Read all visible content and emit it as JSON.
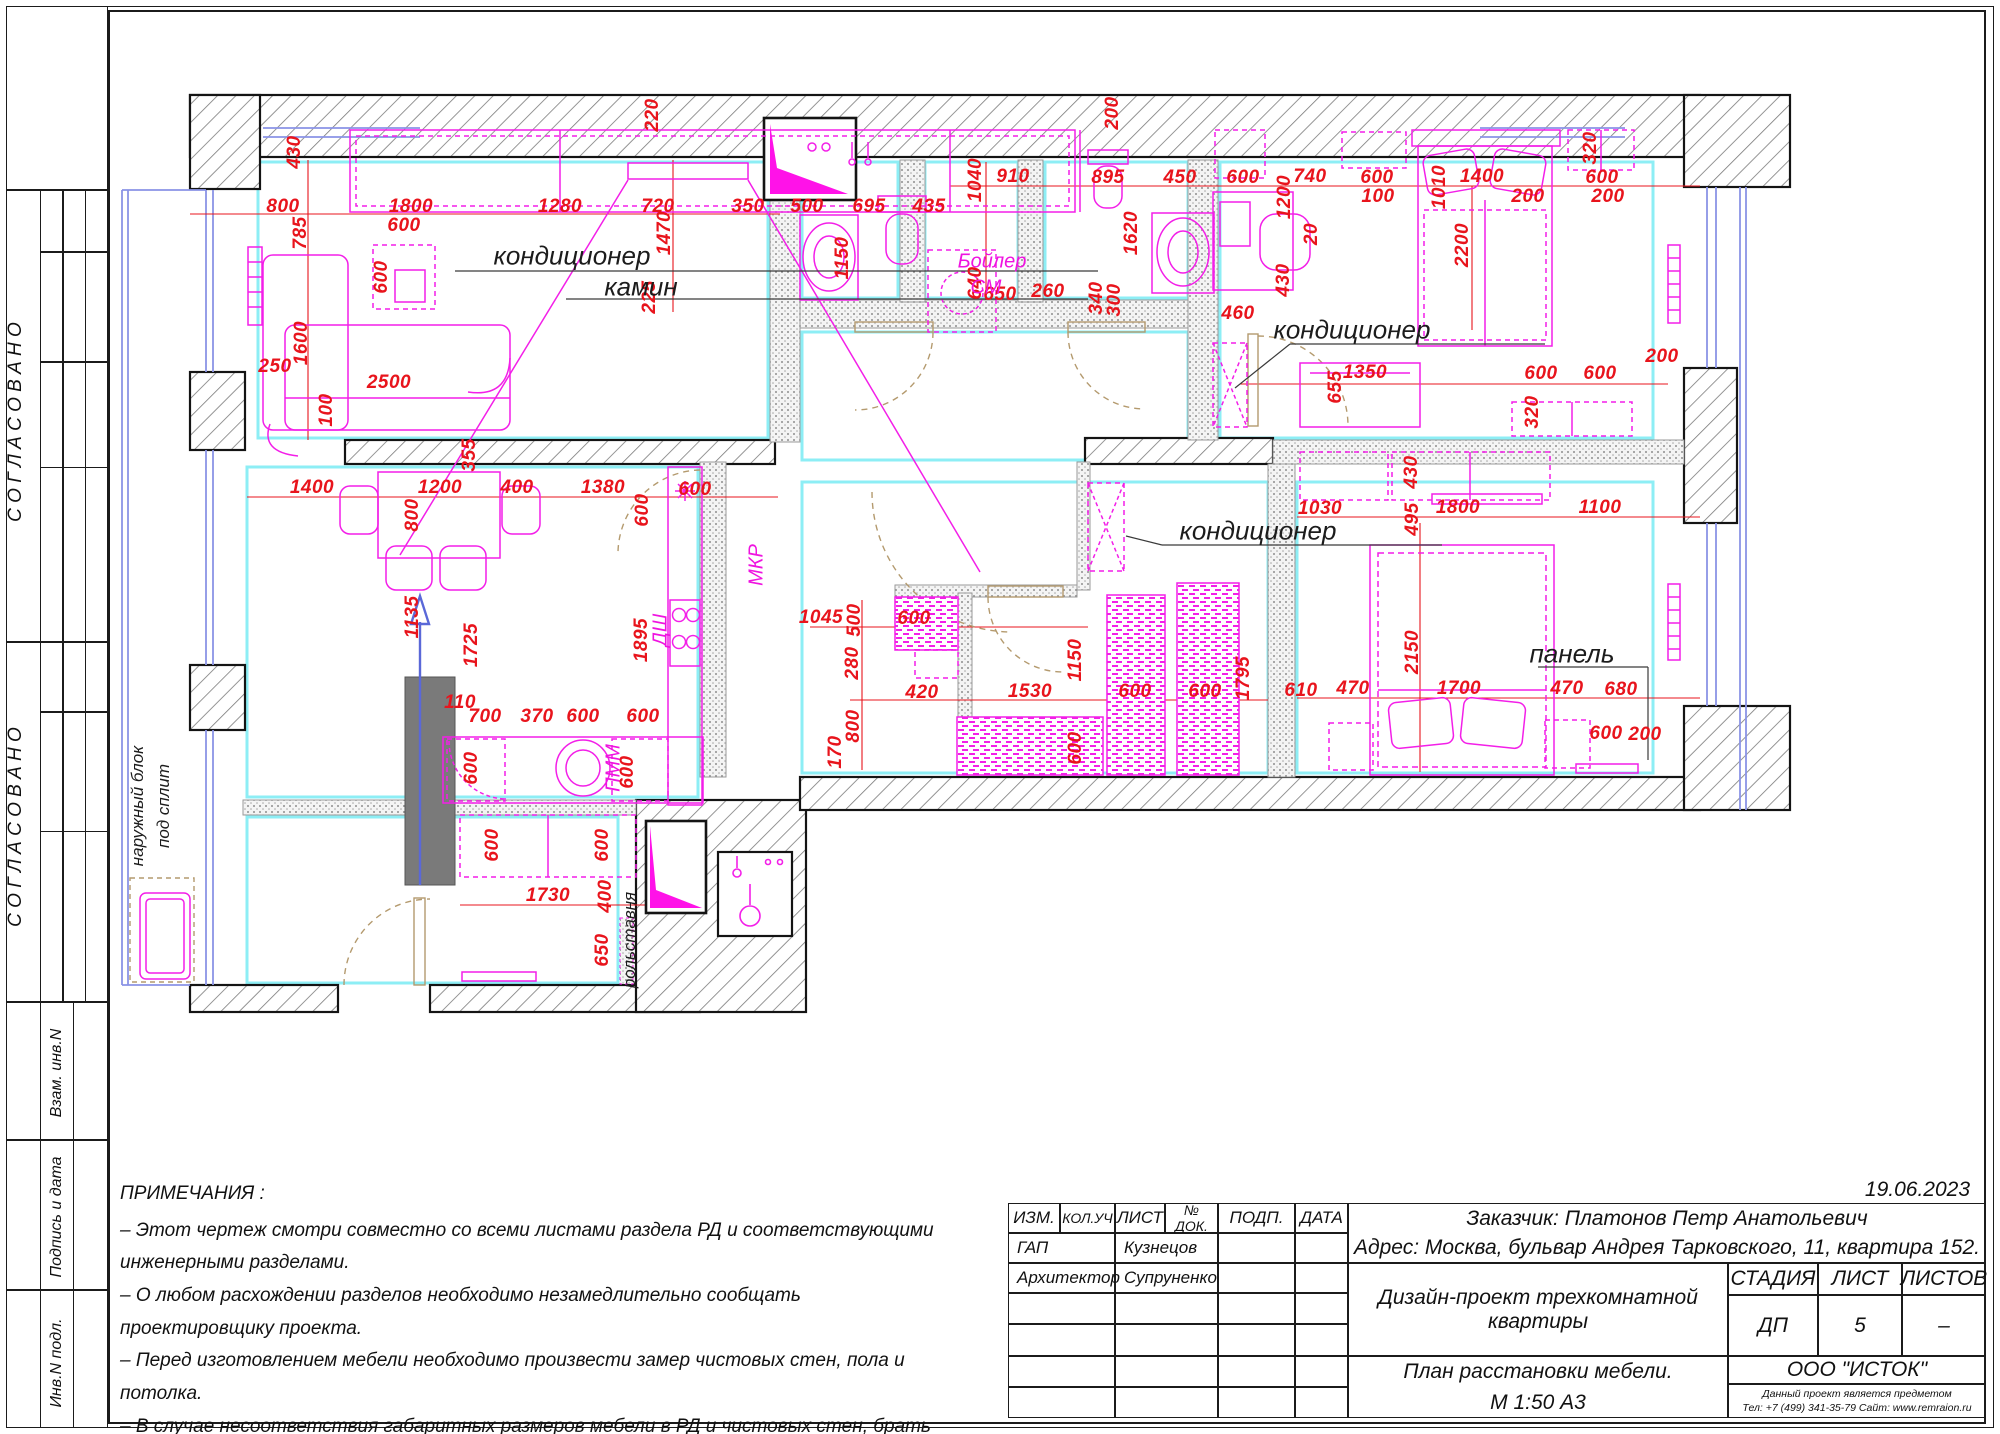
{
  "side_strip": {
    "labels": [
      "С О Г Л А С О В А Н О",
      "С О Г Л А С О В А Н О",
      "Взам. инв.N",
      "Подпись и дата",
      "Инв.N подл."
    ]
  },
  "notes": {
    "title": "ПРИМЕЧАНИЯ :",
    "items": [
      "–  Этот чертеж смотри совместно со всеми листами раздела РД и соответствующими инженерными разделами.",
      "–  О любом расхождении разделов необходимо незамедлительно сообщать проектировщику проекта.",
      "–  Перед изготовлением мебели необходимо произвести замер чистовых стен, пола и потолка.",
      "–  В случае несоответствия габаритных размеров мебели в РД и чистовых стен, брать за основу размеры чистовых стен."
    ]
  },
  "title_block": {
    "date": "19.06.2023",
    "columns": [
      "ИЗМ.",
      "КОЛ.УЧ",
      "ЛИСТ",
      "№ ДОК.",
      "ПОДП.",
      "ДАТА"
    ],
    "rows": [
      {
        "role": "ГАП",
        "name": "Кузнецов"
      },
      {
        "role": "Архитектор",
        "name": "Супруненко"
      }
    ],
    "client": "Заказчик: Платонов Петр Анатольевич",
    "address": "Адрес: Москва, бульвар Андрея Тарковского, 11, квартира 152.",
    "project": "Дизайн-проект трехкомнатной квартиры",
    "stage_label": "СТАДИЯ",
    "sheet_label": "ЛИСТ",
    "sheets_label": "ЛИСТОВ",
    "stage": "ДП",
    "sheet_no": "5",
    "sheets_total": "–",
    "drawing_title": "План расстановки мебели.",
    "drawing_scale": "М 1:50  А3",
    "company": "ООО \"ИСТОК\"",
    "copyright": "Данный проект является предметом авторского права. Тиражирование, публикация, использование в строительстве, прочее коммерческое использование возможно только с согласованием ООО \"ИСТОК\". Защищено законом РФ об авторском праве.",
    "phone": "Тел: +7 (499) 341-35-79  Сайт: www.remraion.ru"
  },
  "plan": {
    "colors": {
      "dim_red": "#e8141c",
      "furniture_magenta": "#f31fe8",
      "wall_black": "#141414",
      "lining_cyan": "#8deef5",
      "door_tan": "#b49a6e",
      "window_blue": "#8a93e6"
    },
    "callouts": [
      {
        "t": "кондиционер",
        "x": 572,
        "y": 256
      },
      {
        "t": "камин",
        "x": 641,
        "y": 287
      },
      {
        "t": "кондиционер",
        "x": 1352,
        "y": 330
      },
      {
        "t": "кондиционер",
        "x": 1258,
        "y": 531
      },
      {
        "t": "панель",
        "x": 1572,
        "y": 654
      },
      {
        "t": "Бойлер",
        "x": 992,
        "y": 262,
        "m": 1
      },
      {
        "t": "СМ",
        "x": 986,
        "y": 288,
        "m": 1
      },
      {
        "t": "МКР",
        "x": 757,
        "y": 565,
        "m": 1,
        "v": 1
      },
      {
        "t": "ДШ",
        "x": 661,
        "y": 630,
        "m": 1,
        "v": 1
      },
      {
        "t": "ПММ",
        "x": 614,
        "y": 768,
        "m": 1,
        "v": 1
      },
      {
        "t": "рольставня",
        "x": 630,
        "y": 940,
        "v": 1,
        "s": 1
      },
      {
        "t": "наружный блок",
        "x": 138,
        "y": 806,
        "v": 1,
        "s": 1
      },
      {
        "t": "под сплит",
        "x": 164,
        "y": 806,
        "v": 1,
        "s": 1
      }
    ],
    "dims": [
      {
        "t": "800",
        "x": 283,
        "y": 207
      },
      {
        "t": "1800",
        "x": 411,
        "y": 207
      },
      {
        "t": "600",
        "x": 404,
        "y": 226
      },
      {
        "t": "1280",
        "x": 560,
        "y": 207
      },
      {
        "t": "720",
        "x": 658,
        "y": 207
      },
      {
        "t": "350",
        "x": 748,
        "y": 207
      },
      {
        "t": "500",
        "x": 807,
        "y": 207
      },
      {
        "t": "695",
        "x": 869,
        "y": 207
      },
      {
        "t": "435",
        "x": 929,
        "y": 207
      },
      {
        "t": "430",
        "x": 295,
        "y": 152,
        "v": 1
      },
      {
        "t": "785",
        "x": 301,
        "y": 233,
        "v": 1
      },
      {
        "t": "220",
        "x": 653,
        "y": 115,
        "v": 1
      },
      {
        "t": "1470",
        "x": 665,
        "y": 233,
        "v": 1
      },
      {
        "t": "225",
        "x": 650,
        "y": 297,
        "v": 1
      },
      {
        "t": "600",
        "x": 382,
        "y": 277,
        "v": 1
      },
      {
        "t": "1600",
        "x": 302,
        "y": 343,
        "v": 1
      },
      {
        "t": "100",
        "x": 327,
        "y": 410,
        "v": 1
      },
      {
        "t": "250",
        "x": 275,
        "y": 367
      },
      {
        "t": "2500",
        "x": 389,
        "y": 383
      },
      {
        "t": "1040",
        "x": 976,
        "y": 180,
        "v": 1
      },
      {
        "t": "910",
        "x": 1013,
        "y": 177
      },
      {
        "t": "1150",
        "x": 843,
        "y": 258,
        "v": 1
      },
      {
        "t": "640",
        "x": 976,
        "y": 283,
        "v": 1
      },
      {
        "t": "650",
        "x": 1000,
        "y": 295
      },
      {
        "t": "260",
        "x": 1048,
        "y": 292
      },
      {
        "t": "340",
        "x": 1097,
        "y": 298,
        "v": 1
      },
      {
        "t": "300",
        "x": 1115,
        "y": 300,
        "v": 1
      },
      {
        "t": "895",
        "x": 1108,
        "y": 178
      },
      {
        "t": "450",
        "x": 1180,
        "y": 178
      },
      {
        "t": "1620",
        "x": 1132,
        "y": 233,
        "v": 1
      },
      {
        "t": "200",
        "x": 1113,
        "y": 113,
        "v": 1
      },
      {
        "t": "600",
        "x": 1243,
        "y": 178
      },
      {
        "t": "740",
        "x": 1310,
        "y": 177
      },
      {
        "t": "1200",
        "x": 1285,
        "y": 197,
        "v": 1
      },
      {
        "t": "600",
        "x": 1377,
        "y": 178
      },
      {
        "t": "100",
        "x": 1378,
        "y": 197
      },
      {
        "t": "1010",
        "x": 1440,
        "y": 187,
        "v": 1
      },
      {
        "t": "1400",
        "x": 1482,
        "y": 177
      },
      {
        "t": "200",
        "x": 1528,
        "y": 197
      },
      {
        "t": "320",
        "x": 1591,
        "y": 148,
        "v": 1
      },
      {
        "t": "600",
        "x": 1602,
        "y": 178
      },
      {
        "t": "200",
        "x": 1608,
        "y": 197
      },
      {
        "t": "20",
        "x": 1312,
        "y": 234,
        "v": 1
      },
      {
        "t": "2200",
        "x": 1463,
        "y": 245,
        "v": 1
      },
      {
        "t": "430",
        "x": 1284,
        "y": 280,
        "v": 1
      },
      {
        "t": "460",
        "x": 1238,
        "y": 314
      },
      {
        "t": "1350",
        "x": 1365,
        "y": 373
      },
      {
        "t": "655",
        "x": 1336,
        "y": 387,
        "v": 1
      },
      {
        "t": "600",
        "x": 1541,
        "y": 374
      },
      {
        "t": "600",
        "x": 1600,
        "y": 374
      },
      {
        "t": "200",
        "x": 1662,
        "y": 357
      },
      {
        "t": "320",
        "x": 1533,
        "y": 412,
        "v": 1
      },
      {
        "t": "355",
        "x": 470,
        "y": 455,
        "v": 1
      },
      {
        "t": "1400",
        "x": 312,
        "y": 488
      },
      {
        "t": "1200",
        "x": 440,
        "y": 488
      },
      {
        "t": "400",
        "x": 517,
        "y": 488
      },
      {
        "t": "1380",
        "x": 603,
        "y": 488
      },
      {
        "t": "600",
        "x": 695,
        "y": 490
      },
      {
        "t": "800",
        "x": 413,
        "y": 515,
        "v": 1
      },
      {
        "t": "600",
        "x": 643,
        "y": 510,
        "v": 1
      },
      {
        "t": "1135",
        "x": 413,
        "y": 617,
        "v": 1
      },
      {
        "t": "1725",
        "x": 472,
        "y": 645,
        "v": 1
      },
      {
        "t": "1895",
        "x": 642,
        "y": 640,
        "v": 1
      },
      {
        "t": "110",
        "x": 460,
        "y": 703
      },
      {
        "t": "700",
        "x": 485,
        "y": 717
      },
      {
        "t": "370",
        "x": 537,
        "y": 717
      },
      {
        "t": "600",
        "x": 583,
        "y": 717
      },
      {
        "t": "600",
        "x": 643,
        "y": 717
      },
      {
        "t": "600",
        "x": 472,
        "y": 768,
        "v": 1
      },
      {
        "t": "600",
        "x": 628,
        "y": 772,
        "v": 1
      },
      {
        "t": "1045",
        "x": 821,
        "y": 618
      },
      {
        "t": "500",
        "x": 855,
        "y": 620,
        "v": 1
      },
      {
        "t": "600",
        "x": 914,
        "y": 619
      },
      {
        "t": "280",
        "x": 853,
        "y": 663,
        "v": 1
      },
      {
        "t": "420",
        "x": 922,
        "y": 693
      },
      {
        "t": "800",
        "x": 854,
        "y": 726,
        "v": 1
      },
      {
        "t": "170",
        "x": 836,
        "y": 752,
        "v": 1
      },
      {
        "t": "1530",
        "x": 1030,
        "y": 692
      },
      {
        "t": "1150",
        "x": 1076,
        "y": 660,
        "v": 1
      },
      {
        "t": "600",
        "x": 1076,
        "y": 748,
        "v": 1
      },
      {
        "t": "600",
        "x": 1135,
        "y": 692
      },
      {
        "t": "600",
        "x": 1205,
        "y": 692
      },
      {
        "t": "1795",
        "x": 1244,
        "y": 678,
        "v": 1
      },
      {
        "t": "1030",
        "x": 1320,
        "y": 509
      },
      {
        "t": "430",
        "x": 1412,
        "y": 472,
        "v": 1
      },
      {
        "t": "495",
        "x": 1413,
        "y": 519,
        "v": 1
      },
      {
        "t": "1800",
        "x": 1458,
        "y": 508
      },
      {
        "t": "1100",
        "x": 1600,
        "y": 508
      },
      {
        "t": "2150",
        "x": 1413,
        "y": 652,
        "v": 1
      },
      {
        "t": "610",
        "x": 1301,
        "y": 691
      },
      {
        "t": "470",
        "x": 1353,
        "y": 689
      },
      {
        "t": "1700",
        "x": 1459,
        "y": 689
      },
      {
        "t": "470",
        "x": 1567,
        "y": 689
      },
      {
        "t": "680",
        "x": 1621,
        "y": 690
      },
      {
        "t": "600",
        "x": 1606,
        "y": 734
      },
      {
        "t": "200",
        "x": 1645,
        "y": 735
      },
      {
        "t": "1730",
        "x": 548,
        "y": 896
      },
      {
        "t": "400",
        "x": 606,
        "y": 896,
        "v": 1
      },
      {
        "t": "650",
        "x": 603,
        "y": 950,
        "v": 1
      },
      {
        "t": "600",
        "x": 493,
        "y": 845,
        "v": 1
      },
      {
        "t": "600",
        "x": 603,
        "y": 845,
        "v": 1
      }
    ]
  }
}
